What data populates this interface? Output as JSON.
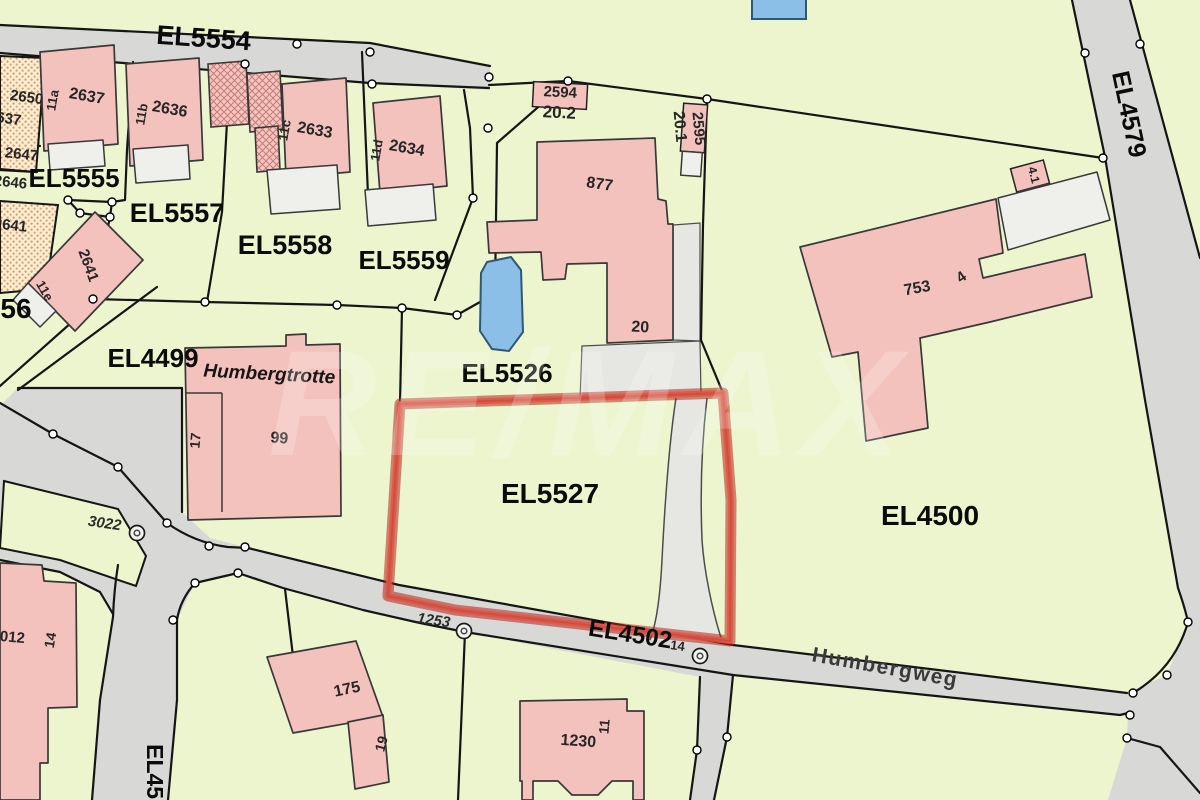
{
  "map": {
    "type": "cadastral-parcel-map",
    "watermark": "RE/MAX",
    "highlighted_parcel": "EL5527",
    "street_names": [
      "Humbergweg"
    ],
    "road_parcels": [
      "EL5554",
      "EL4579",
      "EL4502",
      "EL450"
    ],
    "parcel_ids": [
      "EL5554",
      "EL5555",
      "EL5556",
      "EL5557",
      "EL5558",
      "EL5559",
      "EL5526",
      "EL5527",
      "EL4499",
      "EL4500",
      "EL4502",
      "EL4579"
    ],
    "building_numbers": [
      "2650",
      "2637",
      "2647",
      "2646",
      "2641",
      "2636",
      "2633",
      "2634",
      "2594",
      "2595",
      "877",
      "20",
      "753",
      "99",
      "175",
      "1230",
      "012",
      "14",
      "17",
      "19",
      "11"
    ],
    "house_numbers": [
      "11a",
      "11b",
      "11c",
      "11d",
      "11e",
      "20.1",
      "20.2",
      "4",
      "4.1",
      "11",
      "14",
      "17",
      "19"
    ],
    "point_labels": [
      "3022",
      "1253",
      "14"
    ],
    "named_place": "Humbergtrotte",
    "colors": {
      "parcel_green": "#ecf5cd",
      "building_pink": "#f4c2bd",
      "road_gray": "#d8d8d6",
      "driveway_gray": "#e6e6e2",
      "highlight_red": "#d63a2a",
      "water_blue": "#8cbfe8",
      "hatch_orange": "#dd9550",
      "boundary_black": "#151515"
    },
    "labels": [
      {
        "id": "el5554",
        "text": "EL5554",
        "x": 203,
        "y": 47,
        "rot": 4,
        "size": 27,
        "cls": "p"
      },
      {
        "id": "el5555",
        "text": "EL5555",
        "x": 74,
        "y": 187,
        "rot": 0,
        "size": 26,
        "cls": "p"
      },
      {
        "id": "el5556-partial",
        "text": "56",
        "x": 16,
        "y": 318,
        "rot": 0,
        "size": 28,
        "cls": "p"
      },
      {
        "id": "el5557",
        "text": "EL5557",
        "x": 177,
        "y": 222,
        "rot": 0,
        "size": 27,
        "cls": "p"
      },
      {
        "id": "el5558",
        "text": "EL5558",
        "x": 285,
        "y": 254,
        "rot": 0,
        "size": 27,
        "cls": "p"
      },
      {
        "id": "el5559",
        "text": "EL5559",
        "x": 404,
        "y": 269,
        "rot": 0,
        "size": 26,
        "cls": "p"
      },
      {
        "id": "el5526",
        "text": "EL5526",
        "x": 507,
        "y": 382,
        "rot": 0,
        "size": 26,
        "cls": "p"
      },
      {
        "id": "el5527",
        "text": "EL5527",
        "x": 550,
        "y": 503,
        "rot": 0,
        "size": 28,
        "cls": "p"
      },
      {
        "id": "el4499",
        "text": "EL4499",
        "x": 153,
        "y": 367,
        "rot": 0,
        "size": 26,
        "cls": "p"
      },
      {
        "id": "el4500",
        "text": "EL4500",
        "x": 930,
        "y": 525,
        "rot": 0,
        "size": 28,
        "cls": "p"
      },
      {
        "id": "el4502",
        "text": "EL4502",
        "x": 629,
        "y": 642,
        "rot": 9,
        "size": 24,
        "cls": "p"
      },
      {
        "id": "el4579",
        "text": "EL4579",
        "x": 1121,
        "y": 116,
        "rot": 78,
        "size": 25,
        "cls": "p"
      },
      {
        "id": "el45-vertical",
        "text": "EL450",
        "x": 147,
        "y": 778,
        "rot": 90,
        "size": 23,
        "cls": "p"
      },
      {
        "id": "n2650",
        "text": "2650",
        "x": 26,
        "y": 102,
        "rot": 8,
        "size": 15,
        "cls": "h"
      },
      {
        "id": "n2637-edge",
        "text": "2637",
        "x": 4,
        "y": 123,
        "rot": 8,
        "size": 15,
        "cls": "h"
      },
      {
        "id": "n2647",
        "text": "2647",
        "x": 21,
        "y": 159,
        "rot": 6,
        "size": 15,
        "cls": "h"
      },
      {
        "id": "n2646",
        "text": "2646",
        "x": 10,
        "y": 187,
        "rot": 6,
        "size": 15,
        "cls": "h"
      },
      {
        "id": "n2641-edge",
        "text": "2641",
        "x": 10,
        "y": 230,
        "rot": 6,
        "size": 15,
        "cls": "h"
      },
      {
        "id": "n11a",
        "text": "11a",
        "x": 57,
        "y": 101,
        "rot": -80,
        "size": 13,
        "cls": "h"
      },
      {
        "id": "n2637",
        "text": "2637",
        "x": 86,
        "y": 101,
        "rot": 10,
        "size": 16,
        "cls": "h"
      },
      {
        "id": "n11b",
        "text": "11b",
        "x": 146,
        "y": 115,
        "rot": -80,
        "size": 13,
        "cls": "h"
      },
      {
        "id": "n2636",
        "text": "2636",
        "x": 169,
        "y": 114,
        "rot": 10,
        "size": 16,
        "cls": "h"
      },
      {
        "id": "n11c",
        "text": "11c",
        "x": 289,
        "y": 131,
        "rot": -80,
        "size": 13,
        "cls": "h"
      },
      {
        "id": "n2633",
        "text": "2633",
        "x": 314,
        "y": 135,
        "rot": 10,
        "size": 16,
        "cls": "h"
      },
      {
        "id": "n11d",
        "text": "11d",
        "x": 381,
        "y": 151,
        "rot": -80,
        "size": 13,
        "cls": "h"
      },
      {
        "id": "n2634",
        "text": "2634",
        "x": 406,
        "y": 153,
        "rot": 10,
        "size": 16,
        "cls": "h"
      },
      {
        "id": "n2641",
        "text": "2641",
        "x": 84,
        "y": 267,
        "rot": 70,
        "size": 15,
        "cls": "h"
      },
      {
        "id": "n11e",
        "text": "11e",
        "x": 41,
        "y": 293,
        "rot": 60,
        "size": 13,
        "cls": "h"
      },
      {
        "id": "n2594",
        "text": "2594",
        "x": 560,
        "y": 97,
        "rot": 3,
        "size": 15,
        "cls": "h"
      },
      {
        "id": "n20-2",
        "text": "20.2",
        "x": 559,
        "y": 118,
        "rot": 3,
        "size": 17,
        "cls": "h"
      },
      {
        "id": "n2595",
        "text": "2595",
        "x": 694,
        "y": 129,
        "rot": 85,
        "size": 15,
        "cls": "h"
      },
      {
        "id": "n20-1",
        "text": "20.1",
        "x": 675,
        "y": 127,
        "rot": 85,
        "size": 16,
        "cls": "h"
      },
      {
        "id": "n877",
        "text": "877",
        "x": 599,
        "y": 189,
        "rot": 8,
        "size": 16,
        "cls": "h"
      },
      {
        "id": "n20",
        "text": "20",
        "x": 640,
        "y": 332,
        "rot": 3,
        "size": 16,
        "cls": "h"
      },
      {
        "id": "n753",
        "text": "753",
        "x": 918,
        "y": 293,
        "rot": -10,
        "size": 16,
        "cls": "h"
      },
      {
        "id": "n4",
        "text": "4",
        "x": 964,
        "y": 281,
        "rot": -35,
        "size": 15,
        "cls": "h"
      },
      {
        "id": "n4-1",
        "text": "4.1",
        "x": 1030,
        "y": 176,
        "rot": 75,
        "size": 12,
        "cls": "h"
      },
      {
        "id": "n99",
        "text": "99",
        "x": 279,
        "y": 443,
        "rot": 4,
        "size": 16,
        "cls": "h"
      },
      {
        "id": "n17",
        "text": "17",
        "x": 200,
        "y": 441,
        "rot": -85,
        "size": 14,
        "cls": "h"
      },
      {
        "id": "humbergtrotte",
        "text": "Humbergtrotte",
        "x": 269,
        "y": 380,
        "rot": 3,
        "size": 19,
        "cls": "bi"
      },
      {
        "id": "n3022",
        "text": "3022",
        "x": 104,
        "y": 528,
        "rot": 8,
        "size": 15,
        "cls": "hi"
      },
      {
        "id": "n1253",
        "text": "1253",
        "x": 433,
        "y": 625,
        "rot": 8,
        "size": 15,
        "cls": "hi"
      },
      {
        "id": "n14-road",
        "text": "14",
        "x": 677,
        "y": 650,
        "rot": 8,
        "size": 13,
        "cls": "h"
      },
      {
        "id": "n012",
        "text": "012",
        "x": 12,
        "y": 642,
        "rot": 5,
        "size": 15,
        "cls": "h"
      },
      {
        "id": "n14-bldg",
        "text": "14",
        "x": 55,
        "y": 641,
        "rot": -80,
        "size": 14,
        "cls": "h"
      },
      {
        "id": "n175",
        "text": "175",
        "x": 348,
        "y": 694,
        "rot": -12,
        "size": 16,
        "cls": "h"
      },
      {
        "id": "n19",
        "text": "19",
        "x": 386,
        "y": 745,
        "rot": -75,
        "size": 14,
        "cls": "h"
      },
      {
        "id": "n1230",
        "text": "1230",
        "x": 578,
        "y": 746,
        "rot": 4,
        "size": 16,
        "cls": "h"
      },
      {
        "id": "n11-bldg",
        "text": "11",
        "x": 609,
        "y": 727,
        "rot": -85,
        "size": 14,
        "cls": "h"
      },
      {
        "id": "humbergweg",
        "text": "Humbergweg",
        "x": 884,
        "y": 674,
        "rot": 10,
        "size": 21,
        "cls": "st"
      }
    ]
  }
}
